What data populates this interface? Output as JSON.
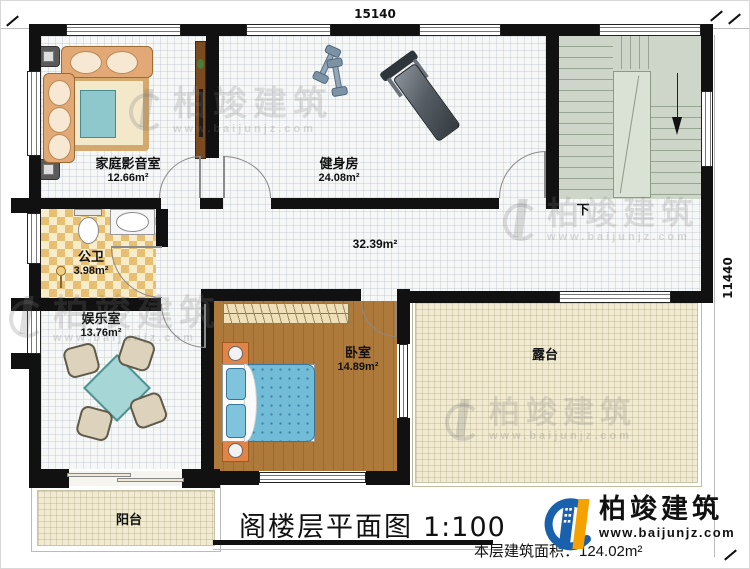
{
  "dimensions": {
    "top": "15140",
    "right": "11440"
  },
  "rooms": {
    "home_theater": {
      "name": "家庭影音室",
      "area": "12.66m²"
    },
    "gym": {
      "name": "健身房",
      "area": "24.08m²"
    },
    "bathroom": {
      "name": "公卫",
      "area": "3.98m²"
    },
    "corridor": {
      "area": "32.39m²"
    },
    "entertainment": {
      "name": "娱乐室",
      "area": "13.76m²"
    },
    "bedroom": {
      "name": "卧室",
      "area": "14.89m²"
    },
    "terrace": {
      "name": "露台"
    },
    "balcony": {
      "name": "阳台"
    }
  },
  "stairs": {
    "direction_label": "下"
  },
  "title": {
    "text": "阁楼层平面图",
    "scale": "1:100"
  },
  "footer": {
    "floor_area": "本层建筑面积：124.02m²"
  },
  "brand": {
    "name": "柏竣建筑",
    "website": "www.baijunjz.com"
  },
  "colors": {
    "wall": "#111111",
    "stairs_floor": "#cdd6c9",
    "wood_floor": "#ad7a3c",
    "terrace_floor": "#f1ebd3",
    "bathroom_tile": "#e7bf72",
    "bed_blue": "#72bcd8",
    "sofa_tan": "#e2a876",
    "logo_blue": "#1961ac",
    "logo_orange": "#f5a100"
  }
}
